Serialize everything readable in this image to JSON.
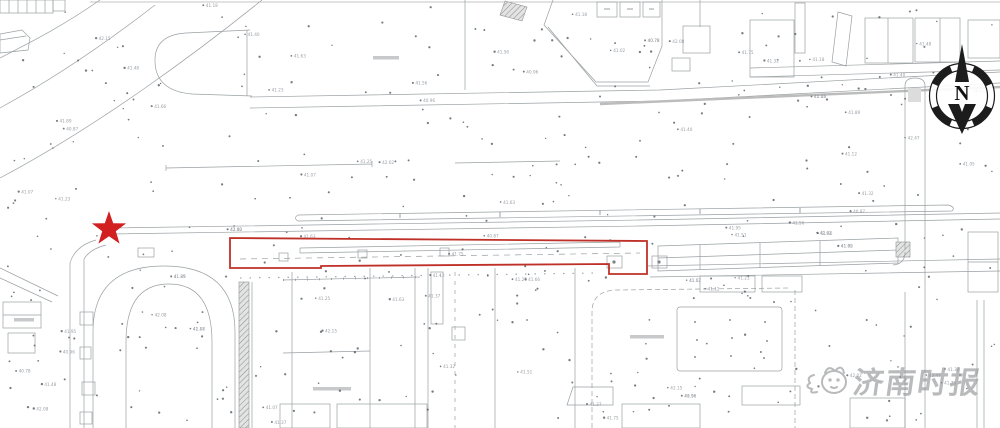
{
  "page": {
    "background": "#ffffff",
    "width": 1000,
    "height": 428
  },
  "compass": {
    "label": "N"
  },
  "watermark": {
    "text": "济南时报",
    "color": "#8f9193"
  },
  "annotations": {
    "star_marker": {
      "color": "#d21f1f",
      "x": 109,
      "y": 229
    },
    "highlight_box": {
      "color": "#bf3128",
      "x": 230,
      "y": 238,
      "width": 417,
      "height": 36
    }
  },
  "map": {
    "line_color": "#9aa0a3",
    "label_color": "#9aa0a6",
    "elevation_values": [
      "41.25",
      "41.32",
      "41.07",
      "41.48",
      "41.56",
      "42.02",
      "41.75",
      "41.18",
      "40.96",
      "41.63",
      "41.40",
      "41.89",
      "42.15",
      "41.02",
      "40.87",
      "41.51",
      "41.66",
      "41.23",
      "41.95",
      "42.08",
      "42.47",
      "41.12",
      "40.78",
      "41.37"
    ],
    "scatter": {
      "dot_count": 430,
      "label_count": 85,
      "seed": 20240613
    }
  }
}
